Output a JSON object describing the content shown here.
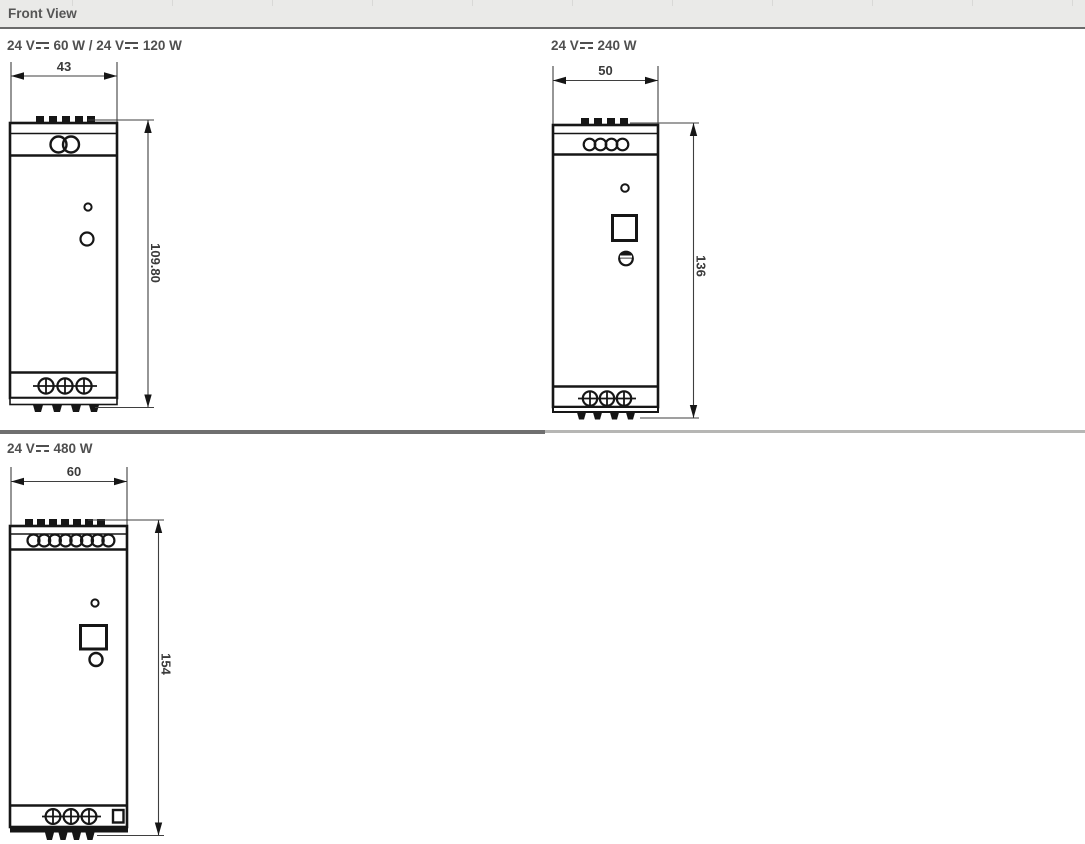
{
  "header": {
    "title": "Front View"
  },
  "panels": [
    {
      "label": "24 V⎓ 60 W / 24 V⎓ 120 W",
      "width_mm": "43",
      "height_mm": "109.80"
    },
    {
      "label": "24 V⎓ 240 W",
      "width_mm": "50",
      "height_mm": "136"
    },
    {
      "label": "24 V⎓ 480 W",
      "width_mm": "60",
      "height_mm": "154"
    }
  ],
  "colors": {
    "drawing_line": "#161616",
    "dimension_text": "#3a3a3a",
    "header_background": "#eaeae8",
    "header_text": "#555555",
    "divider_dark": "#6f6f6f",
    "divider_light": "#b6b6b4"
  }
}
